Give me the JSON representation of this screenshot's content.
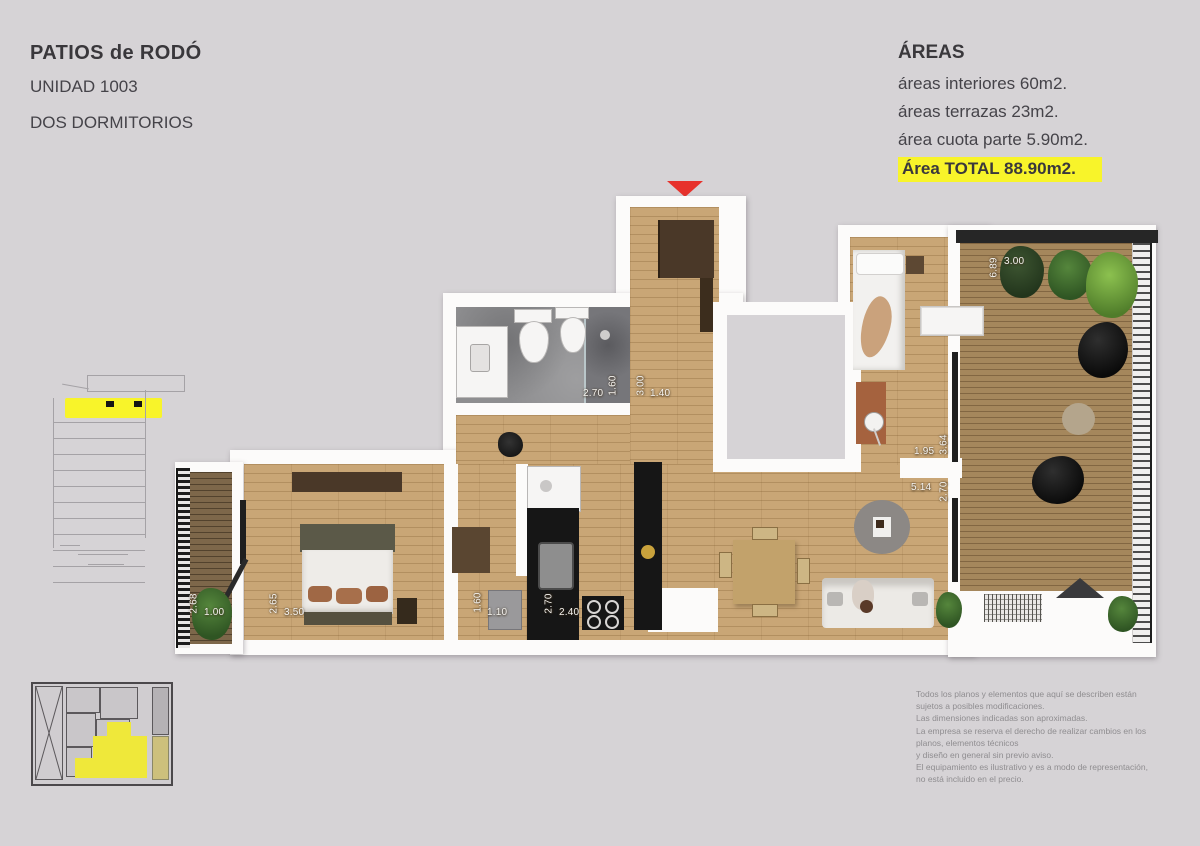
{
  "header": {
    "project_title": "PATIOS de RODÓ",
    "unit": "UNIDAD 1003",
    "unit_type": "DOS DORMITORIOS"
  },
  "areas": {
    "title": "ÁREAS",
    "interior": "áreas interiores 60m2.",
    "terraces": "áreas terrazas 23m2.",
    "quota": "área cuota parte 5.90m2.",
    "total": "Área TOTAL 88.90m2."
  },
  "floorplan": {
    "dimensions": {
      "bath_width": "2.70",
      "bath_depth": "1.60",
      "entry_length": "3.00",
      "entry_width": "1.40",
      "terrace_length": "6.89",
      "terrace_width": "3.00",
      "bedroom2_width": "1.95",
      "bedroom2_length": "3.64",
      "living_length": "5.14",
      "living_width": "2.70",
      "balcony_depth": "2.68",
      "balcony_width": "1.00",
      "bedroom1_depth": "2.65",
      "bedroom1_width": "3.50",
      "laundry_depth": "1.60",
      "laundry_width": "1.10",
      "kitchen_depth": "2.70",
      "kitchen_width": "2.40"
    }
  },
  "disclaimer": {
    "lines": [
      "Todos los planos y elementos que aquí se describen están",
      "sujetos a posibles modificaciones.",
      "Las dimensiones indicadas son aproximadas.",
      "La empresa se reserva el derecho de realizar cambios en los",
      "planos, elementos técnicos",
      "y diseño en general sin previo aviso.",
      "El equipamiento es ilustrativo y es a modo de representación,",
      "no está incluido en el precio."
    ]
  },
  "colors": {
    "background": "#d6d3d6",
    "highlight_yellow": "#f8f42a",
    "accent_red": "#e7322c",
    "wood_interior": "#c9a676",
    "wood_terrace": "#a5875c",
    "wall_white": "#fcfbfa"
  }
}
